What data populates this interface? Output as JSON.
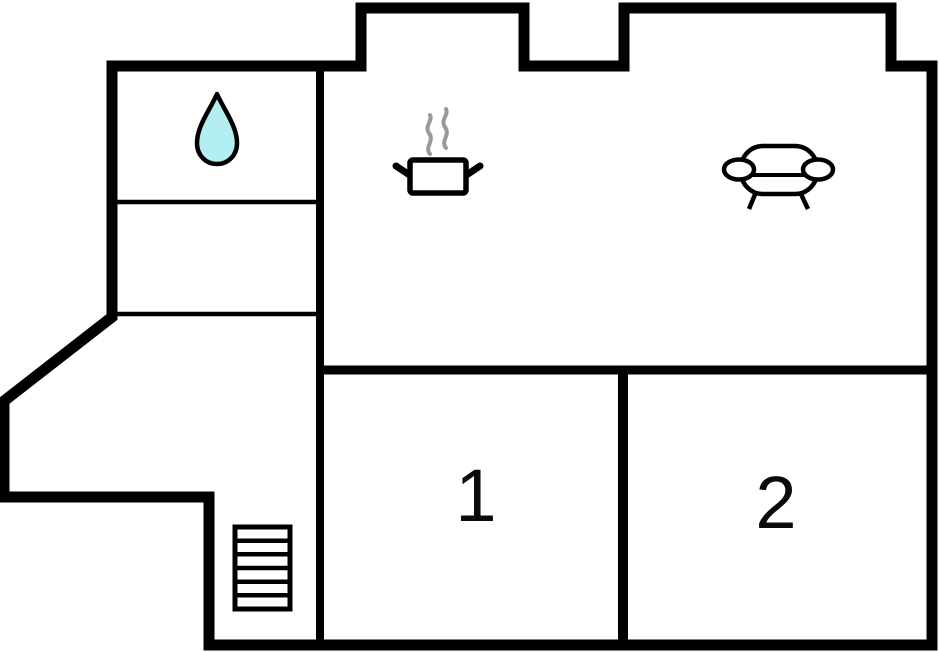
{
  "floorplan": {
    "type": "apartment-floor-plan",
    "colors": {
      "wall": "#000000",
      "floor": "#ffffff",
      "water_drop_fill": "#b3eff1",
      "water_drop_outline": "#000000",
      "steam": "#999999",
      "label_text": "#0a0a0a"
    },
    "rooms": [
      {
        "id": "bathroom",
        "icon": "water-drop-icon",
        "label": ""
      },
      {
        "id": "storage",
        "label": ""
      },
      {
        "id": "hall",
        "label": ""
      },
      {
        "id": "kitchen",
        "icon": "cooking-pot-icon",
        "label": ""
      },
      {
        "id": "living-room",
        "icon": "sofa-icon",
        "label": ""
      },
      {
        "id": "bedroom-1",
        "label": "1"
      },
      {
        "id": "bedroom-2",
        "label": "2"
      },
      {
        "id": "stairwell",
        "icon": "stairs-icon",
        "steps": 6
      }
    ]
  }
}
